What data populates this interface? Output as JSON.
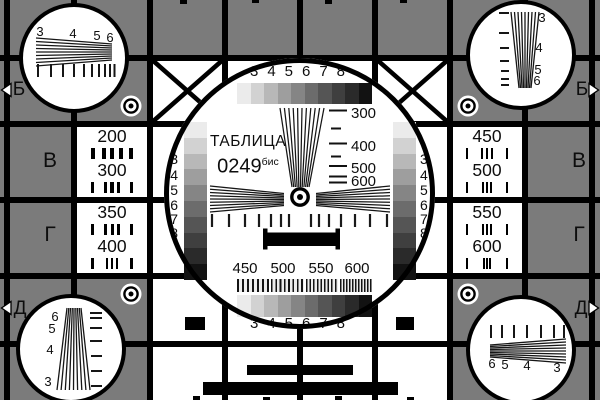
{
  "card": {
    "bg_gray": "#7b7b7b",
    "title": {
      "line1": "ТАБЛИЦА",
      "number": "0249",
      "suffix": "бис"
    },
    "row_letters": {
      "b": "Б",
      "v": "В",
      "g": "Г",
      "d": "Д"
    },
    "grayscale_labels": [
      "3",
      "4",
      "5",
      "6",
      "7",
      "8"
    ],
    "grayscale_steps": [
      "#ebebeb",
      "#d2d2d2",
      "#b8b8b8",
      "#9e9e9e",
      "#858585",
      "#6c6c6c",
      "#555555",
      "#3f3f3f",
      "#2a2a2a",
      "#121212"
    ],
    "center_scale_labels": [
      "300",
      "400",
      "500",
      "600"
    ],
    "burst_scale_labels": [
      "450",
      "500",
      "550",
      "600"
    ],
    "res_cells": {
      "left_top": [
        "200",
        "300"
      ],
      "left_bottom": [
        "350",
        "400"
      ],
      "right_top": [
        "450",
        "500"
      ],
      "right_bottom": [
        "550",
        "600"
      ]
    },
    "corner_labels": {
      "top_left": [
        "3",
        "4",
        "5",
        "6"
      ],
      "top_right": [
        "3",
        "4",
        "5",
        "6"
      ],
      "bottom_left": [
        "6",
        "5",
        "4",
        "3"
      ],
      "bottom_right": [
        "6",
        "5",
        "4",
        "3"
      ]
    }
  }
}
